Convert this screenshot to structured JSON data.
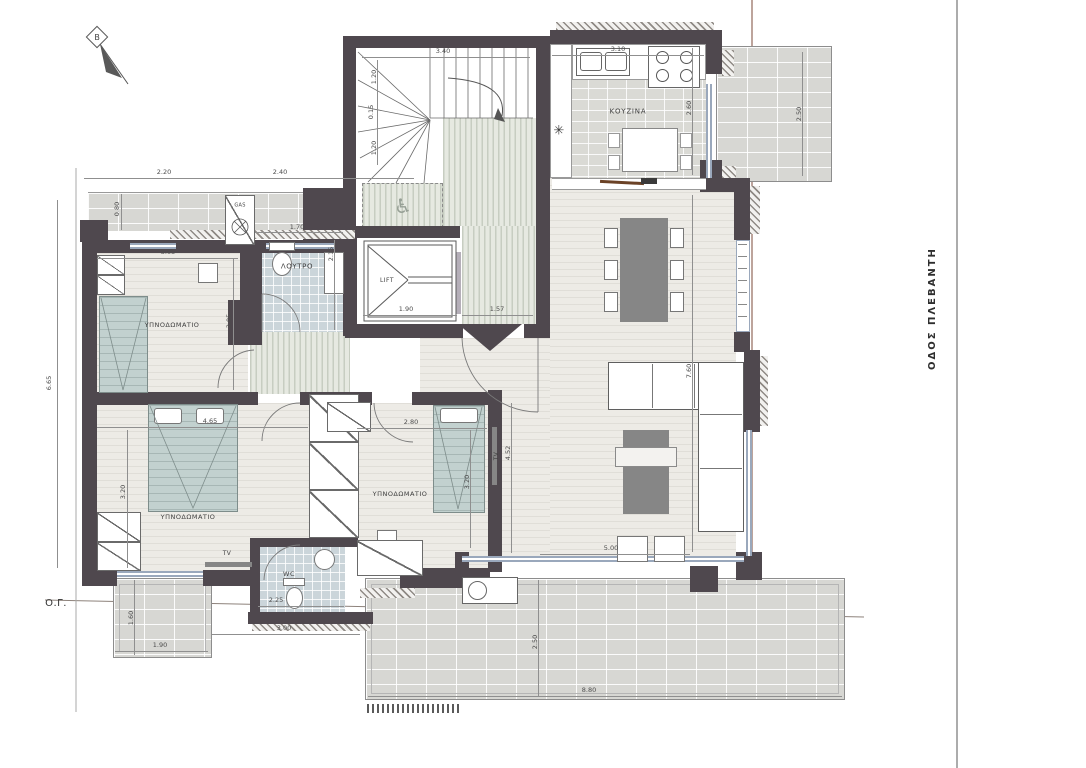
{
  "drawing": {
    "type": "apartment-floor-plan",
    "north_label": "Β",
    "street_label": "ΟΔΟΣ ΠΛΕΒΑΝΤΗ",
    "building_line_label": "Ο.Γ."
  },
  "colors": {
    "wall": "#4f484e",
    "window": "#9aa8bc",
    "bed_fabric": "#c2d1cf",
    "dark_furniture": "#868686",
    "property_line": "#7b4a38",
    "street_line": "#909090"
  },
  "labels": [
    {
      "id": "kitchen",
      "text": "ΚΟΥΖΙΝΑ",
      "x": 628,
      "y": 112,
      "size": 7,
      "ls": 0.8
    },
    {
      "id": "bathroom",
      "text": "ΛΟΥΤΡΟ",
      "x": 297,
      "y": 267,
      "size": 7,
      "ls": 0.6
    },
    {
      "id": "lift",
      "text": "LIFT",
      "x": 387,
      "y": 281,
      "size": 6,
      "ls": 0.5
    },
    {
      "id": "bedroom-1",
      "text": "ΥΠΝΟΔΩΜΑΤΙΟ",
      "x": 172,
      "y": 325,
      "size": 6.5,
      "ls": 0.5
    },
    {
      "id": "bedroom-2",
      "text": "ΥΠΝΟΔΩΜΑΤΙΟ",
      "x": 188,
      "y": 517,
      "size": 6.5,
      "ls": 0.5
    },
    {
      "id": "bedroom-3",
      "text": "ΥΠΝΟΔΩΜΑΤΙΟ",
      "x": 400,
      "y": 494,
      "size": 6.5,
      "ls": 0.5
    },
    {
      "id": "wc",
      "text": "WC",
      "x": 289,
      "y": 574,
      "size": 6.5,
      "ls": 0.5
    },
    {
      "id": "gas",
      "text": "GAS",
      "x": 240,
      "y": 206,
      "size": 5,
      "ls": 0.3
    },
    {
      "id": "tv-bedroom-2",
      "text": "TV",
      "x": 227,
      "y": 554,
      "size": 6,
      "ls": 0.4
    },
    {
      "id": "tv-bedroom-3",
      "text": "TV",
      "x": 497,
      "y": 456,
      "size": 6,
      "ls": 0.4,
      "rot": -90
    },
    {
      "id": "fridge-symbol",
      "text": "✳",
      "x": 559,
      "y": 131,
      "size": 13,
      "color": "#3d3d3d"
    },
    {
      "id": "wheelchair-symbol",
      "text": "♿",
      "x": 403,
      "y": 206,
      "size": 20,
      "color": "#97a096"
    },
    {
      "id": "building-line",
      "text": "Ο.Γ.",
      "x": 56,
      "y": 604,
      "size": 10,
      "color": "#333333",
      "ls": 0.5
    }
  ],
  "dimensions": [
    {
      "label": "2.20",
      "x": 164,
      "y": 172,
      "line": [
        84,
        178,
        246,
        178
      ]
    },
    {
      "label": "2.40",
      "x": 280,
      "y": 172,
      "line": [
        246,
        178,
        414,
        178
      ]
    },
    {
      "label": "3.40",
      "x": 443,
      "y": 51,
      "line": [
        362,
        57,
        530,
        57
      ]
    },
    {
      "label": "3.10",
      "x": 618,
      "y": 49,
      "line": [
        552,
        55,
        704,
        55
      ]
    },
    {
      "label": "1.20",
      "x": 374,
      "y": 77,
      "rot": true,
      "line": [
        377,
        60,
        377,
        165
      ]
    },
    {
      "label": "0.15",
      "x": 371,
      "y": 112,
      "rot": true
    },
    {
      "label": "1.20",
      "x": 374,
      "y": 148,
      "rot": true
    },
    {
      "label": "2.60",
      "x": 689,
      "y": 108,
      "rot": true,
      "line": [
        692,
        48,
        692,
        175
      ]
    },
    {
      "label": "2.50",
      "x": 799,
      "y": 114,
      "rot": true,
      "line": [
        802,
        52,
        802,
        176
      ]
    },
    {
      "label": "0.80",
      "x": 117,
      "y": 209,
      "rot": true,
      "line": [
        121,
        194,
        121,
        230
      ]
    },
    {
      "label": "3.05",
      "x": 168,
      "y": 252,
      "line": [
        97,
        258,
        238,
        258
      ]
    },
    {
      "label": "3.05",
      "x": 229,
      "y": 321,
      "rot": true,
      "line": [
        233,
        258,
        233,
        390
      ]
    },
    {
      "label": "1.70",
      "x": 297,
      "y": 227,
      "line": [
        255,
        232,
        343,
        232
      ]
    },
    {
      "label": "2.15",
      "x": 331,
      "y": 254,
      "rot": true,
      "line": [
        334,
        240,
        334,
        330
      ]
    },
    {
      "label": "1.90",
      "x": 406,
      "y": 309,
      "line": [
        363,
        315,
        457,
        315
      ]
    },
    {
      "label": "1.57",
      "x": 497,
      "y": 309,
      "line": [
        462,
        315,
        533,
        315
      ]
    },
    {
      "label": "6.65",
      "x": 49,
      "y": 383,
      "rot": true,
      "line": [
        57,
        200,
        57,
        568
      ]
    },
    {
      "label": "4.65",
      "x": 210,
      "y": 421,
      "line": [
        97,
        427,
        308,
        427
      ]
    },
    {
      "label": "3.20",
      "x": 123,
      "y": 492,
      "rot": true,
      "line": [
        127,
        430,
        127,
        568
      ]
    },
    {
      "label": "2.80",
      "x": 411,
      "y": 422,
      "line": [
        357,
        428,
        487,
        428
      ]
    },
    {
      "label": "3.20",
      "x": 467,
      "y": 482,
      "rot": true,
      "line": [
        470,
        430,
        470,
        548
      ]
    },
    {
      "label": "4.52",
      "x": 508,
      "y": 453,
      "rot": true,
      "line": [
        511,
        403,
        511,
        553
      ]
    },
    {
      "label": "7.60",
      "x": 689,
      "y": 371,
      "rot": true,
      "line": [
        692,
        195,
        692,
        552
      ]
    },
    {
      "label": "5.00",
      "x": 611,
      "y": 548,
      "line": [
        540,
        554,
        690,
        554
      ]
    },
    {
      "label": "1.60",
      "x": 131,
      "y": 618,
      "rot": true,
      "line": [
        134,
        580,
        134,
        655
      ]
    },
    {
      "label": "1.90",
      "x": 160,
      "y": 645,
      "line": [
        115,
        651,
        208,
        651
      ]
    },
    {
      "label": "3.00",
      "x": 284,
      "y": 628,
      "line": [
        212,
        634,
        360,
        634
      ]
    },
    {
      "label": "2.25",
      "x": 276,
      "y": 600,
      "line": [
        258,
        606,
        344,
        606
      ]
    },
    {
      "label": "2.50",
      "x": 535,
      "y": 642,
      "rot": true,
      "line": [
        538,
        580,
        538,
        696
      ]
    },
    {
      "label": "8.80",
      "x": 589,
      "y": 690,
      "line": [
        368,
        696,
        842,
        696
      ]
    }
  ]
}
